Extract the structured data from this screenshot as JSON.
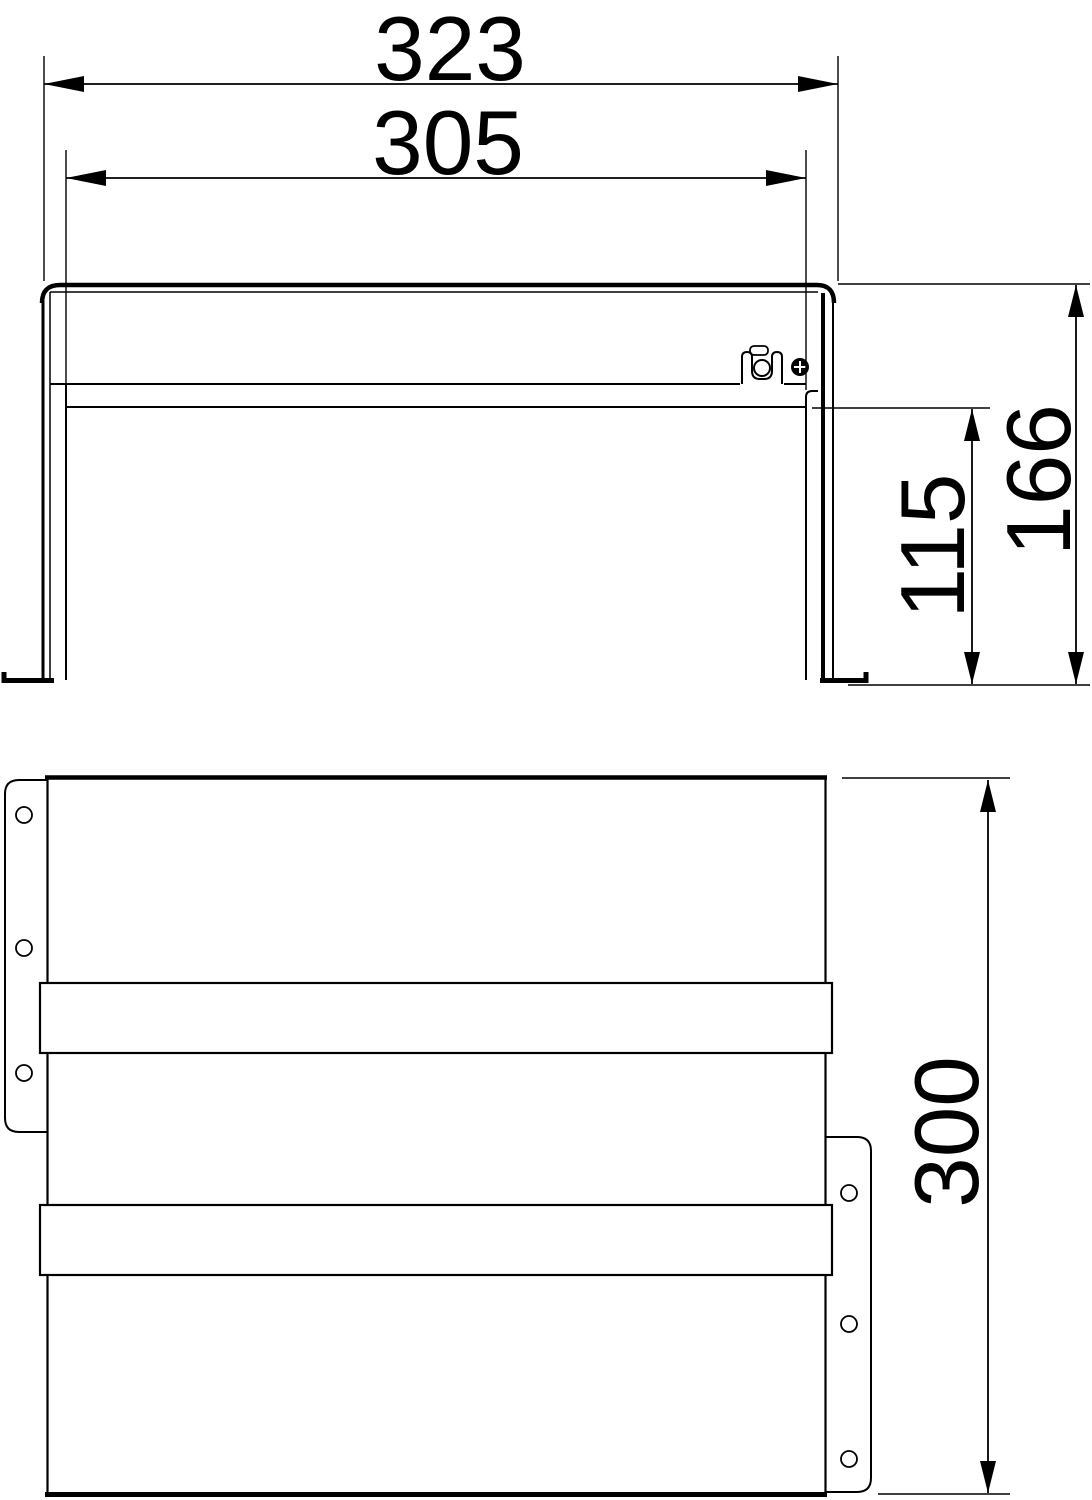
{
  "drawing": {
    "type": "dimensioned-technical-drawing",
    "background": "#ffffff",
    "line_color": "#000000",
    "views": {
      "front": {
        "name": "front-elevation-view",
        "dimensions": [
          {
            "id": "overall-width",
            "label": "323",
            "orientation": "horizontal"
          },
          {
            "id": "inner-width",
            "label": "305",
            "orientation": "horizontal"
          },
          {
            "id": "overall-height",
            "label": "166",
            "orientation": "vertical"
          },
          {
            "id": "leg-height",
            "label": "115",
            "orientation": "vertical"
          }
        ]
      },
      "plan": {
        "name": "plan-view",
        "dimensions": [
          {
            "id": "depth",
            "label": "300",
            "orientation": "vertical"
          }
        ]
      }
    }
  }
}
